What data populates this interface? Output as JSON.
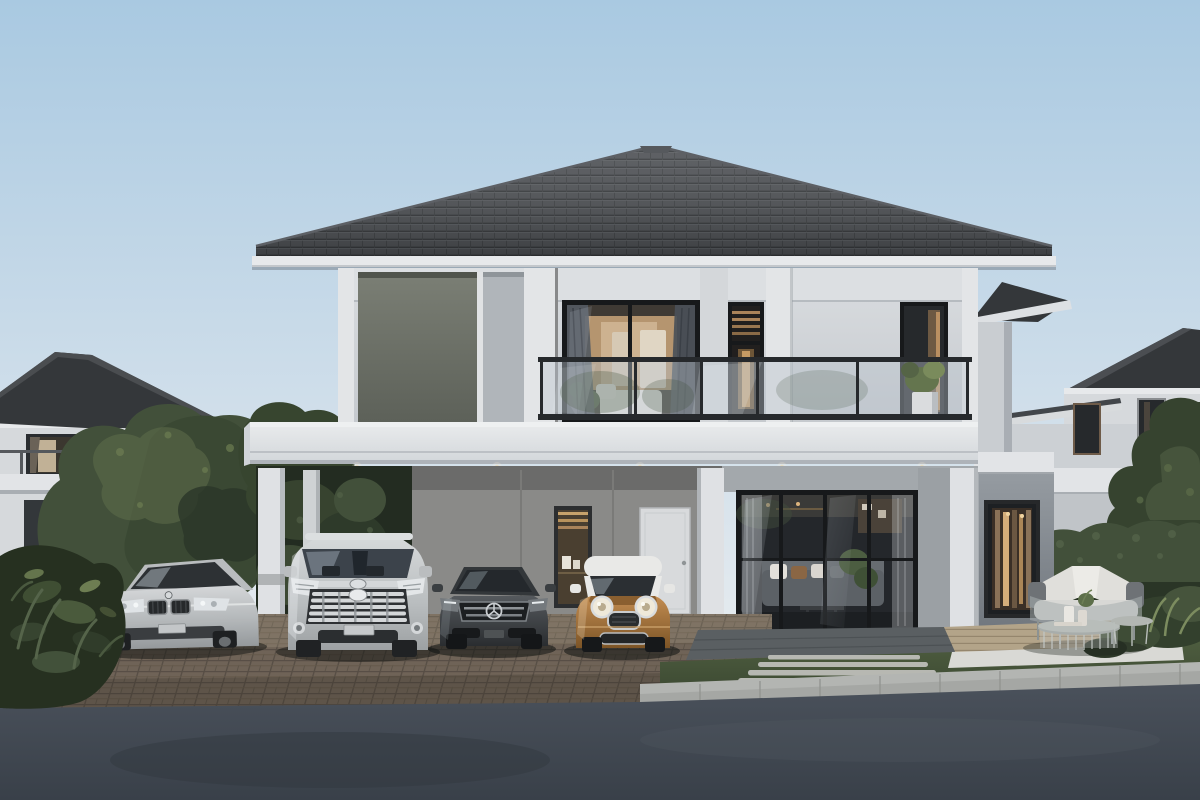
{
  "scene": {
    "type": "3d-architectural-rendering",
    "setting": "Photorealistic dusk rendering of a modern two-story detached house with carport, balcony and four parked cars",
    "time_of_day": "dusk",
    "main_house": {
      "stories": 2,
      "roof": "dark gray tiled hip roof with white fascia",
      "features": [
        "second-floor balcony with black-framed glass railing",
        "dark feature wall panel on upper left facade",
        "large bedroom window with warm interior light and curtains",
        "narrow stairwell window",
        "white potted plant on balcony",
        "carport under cantilevered white slab with recessed downlights",
        "white entrance door and slim interior display window",
        "floor-to-ceiling black-framed living room glazing with sofa and plants inside",
        "single-story side wing with warm lit window"
      ]
    },
    "vehicles": [
      {
        "name": "silver-sedan",
        "color": "silver",
        "position": "far left on driveway"
      },
      {
        "name": "silver-minivan",
        "color": "silver",
        "position": "center-left under carport"
      },
      {
        "name": "graphite-sedan",
        "color": "dark graphite gray",
        "position": "center under carport"
      },
      {
        "name": "bronze-hatchback",
        "color": "bronze with white roof",
        "position": "center-right under carport"
      }
    ],
    "landscape": [
      "dense green trees between houses",
      "dark foreground shrub bed on left",
      "clipped hedge and tropical plants on right",
      "lawn strip with light stepping-stone pavers",
      "brown brick-paver driveway",
      "concrete curb",
      "asphalt road in foreground",
      "wooden terrace with gray wicker sofa, white cushions and round coffee tables"
    ],
    "neighbor_houses": [
      "two-story house with hip roof and balcony at far left",
      "two-story house with hip roof at far right"
    ]
  },
  "palette": {
    "sky_top": "#a9c9e1",
    "sky_mid": "#cfdeea",
    "sky_horizon": "#e9edf0",
    "roof_tile": "#4c4f53",
    "roof_line": "#34373a",
    "fascia_white": "#e7e9eb",
    "wall_light": "#d6d9dc",
    "wall_trim": "#e3e5e7",
    "panel_dark": "#6e7268",
    "slab_white": "#e2e4e7",
    "frame_black": "#17191b",
    "carport_wall": "#8a8a88",
    "column_white": "#dfe1e4",
    "door_white": "#d8dadc",
    "interior_warm": "#c2a076",
    "warm_light": "#dcb47e",
    "curtain_dark": "#4e545b",
    "wing_gray": "#7e848b",
    "paver_brown": "#6f6357",
    "paver_joint": "#574e45",
    "patio_tile": "#5a5f62",
    "grass_green": "#47553a",
    "tree_dark": "#2b3628",
    "tree_mid": "#42503a",
    "tree_light": "#5e6d4a",
    "deck_wood": "#b3a489",
    "curb_gray": "#b3b5b2",
    "road_asphalt": "#454c55",
    "car_silver": "#c8cacc",
    "car_graphite": "#3f4347",
    "car_bronze": "#a9783f",
    "mini_roof": "#e9e9e7",
    "chrome": "#d4d7d9",
    "cushion_white": "#e0dfdb",
    "shrub_dark": "#263020"
  }
}
